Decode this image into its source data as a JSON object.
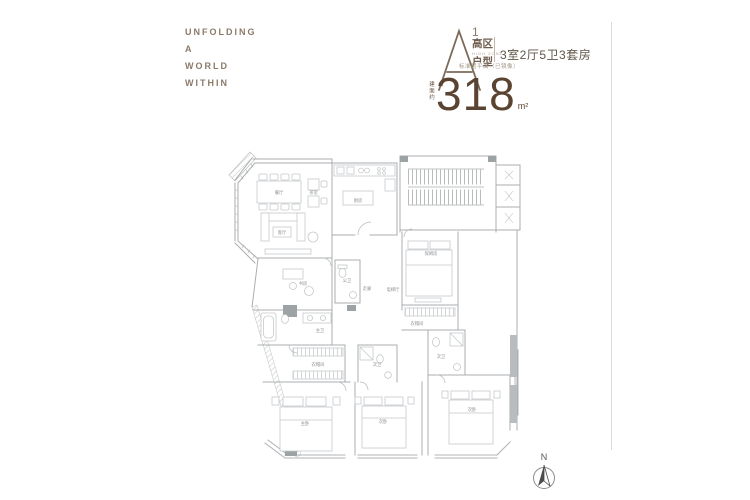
{
  "brand": {
    "lines": [
      "UNFOLDING",
      "A",
      "WORLD",
      "WITHIN"
    ]
  },
  "unit": {
    "letter": "A",
    "superscript": "1",
    "zone": "高区",
    "zone_en": "HIGH ZONE",
    "type_label": "户型",
    "layout_desc": "3室2厅5卫3套房",
    "note": "标准层平面（已镜像）",
    "area_prefix": "建面约",
    "area_value": "318",
    "area_unit": "m²"
  },
  "floorplan": {
    "rooms": [
      {
        "name": "餐厅"
      },
      {
        "name": "茶室"
      },
      {
        "name": "客厅"
      },
      {
        "name": "厨房"
      },
      {
        "name": "书房"
      },
      {
        "name": "公卫"
      },
      {
        "name": "走廊"
      },
      {
        "name": "电梯厅"
      },
      {
        "name": "保姆房"
      },
      {
        "name": "衣帽间"
      },
      {
        "name": "次卫"
      },
      {
        "name": "次卧"
      },
      {
        "name": "主卫"
      },
      {
        "name": "衣帽间"
      },
      {
        "name": "主卧"
      },
      {
        "name": "次卫"
      },
      {
        "name": "次卧"
      }
    ]
  },
  "compass": {
    "label": "N"
  },
  "colors": {
    "brand_brown": "#8b7a69",
    "accent_brown": "#5a4331",
    "plan_line": "#aaaeb0",
    "label_gray": "#8d9092"
  }
}
